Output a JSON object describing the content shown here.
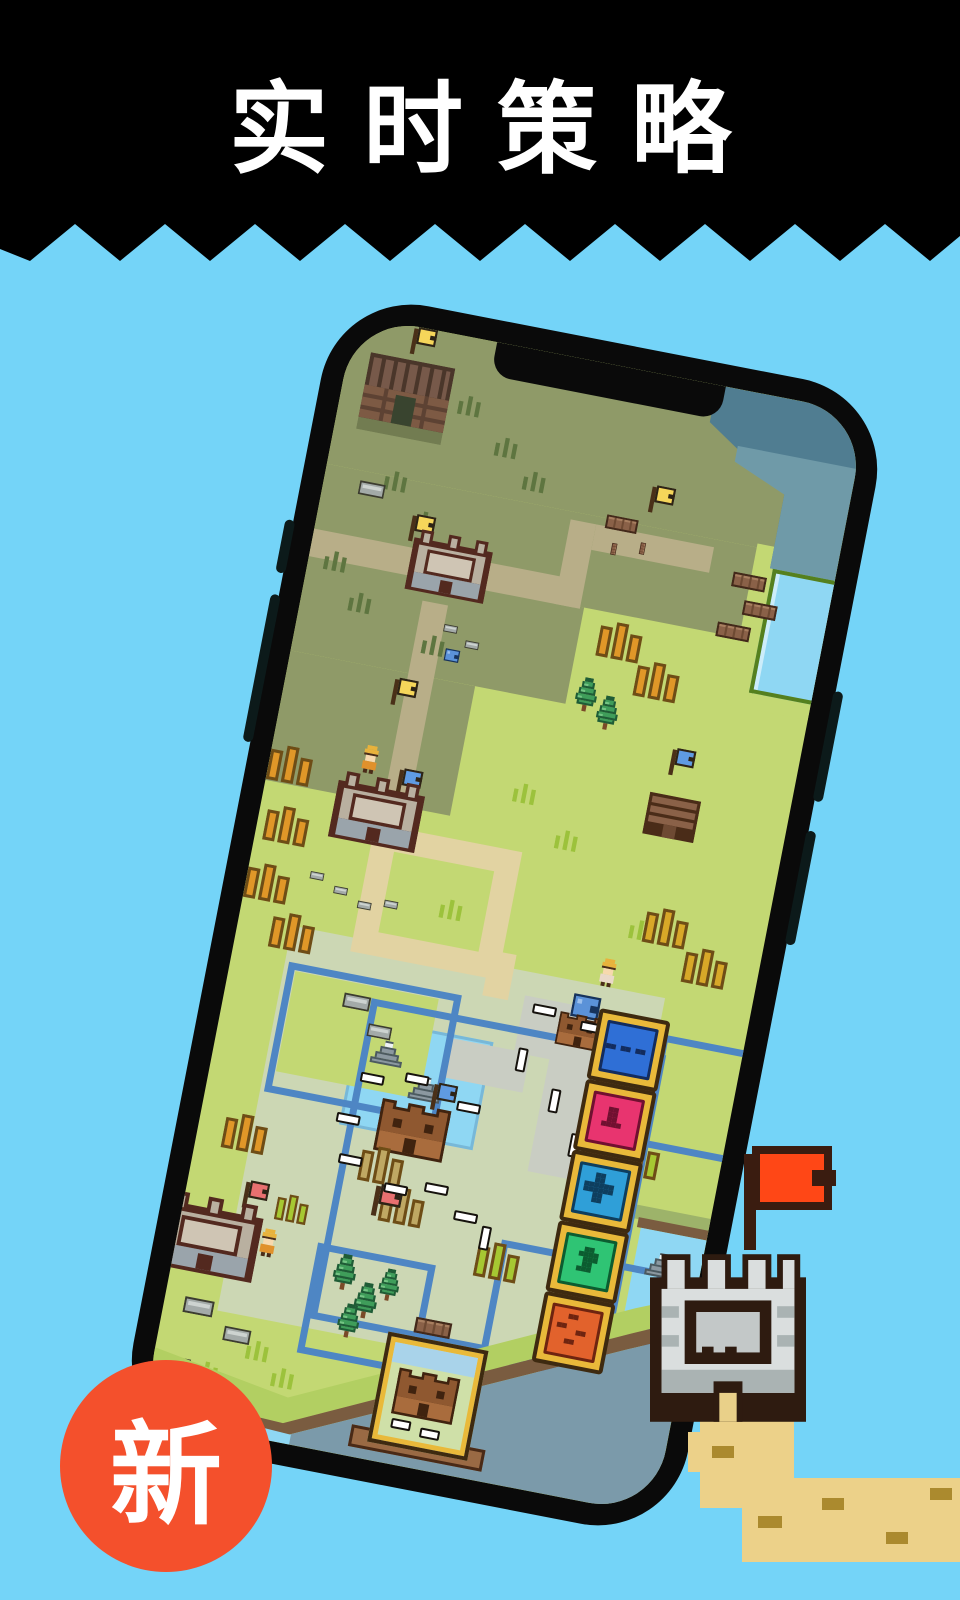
{
  "banner": {
    "title": "实时策略"
  },
  "badge": {
    "label": "新"
  },
  "colors": {
    "--bg": "#74d4f8",
    "--banner-bg": "#000000",
    "--banner-text": "#ffffff",
    "--badge-bg": "#f4502c",
    "--badge-text": "#ffffff",
    "--bezel": "#0a0a0a",
    "--bezel-btn": "#0c1a1a",
    "--grass": "#c3d873",
    "--grass-fog": "#8f9a68",
    "--sage": "#ccd7b4",
    "--water": "#8fd7f3",
    "--water-fog": "#507d91",
    "--water-fog2": "#6f9aa8",
    "--river-fog": "#7b9aaa",
    "--path": "#e2d3a2",
    "--path-fog": "#b8ae88",
    "--plaza": "#c9cdc3",
    "--border-blue": "#4e86c4",
    "--bank": "#b2cf62",
    "--dirt": "#7a5c40",
    "--rail-wood": "#8a5a38",
    "--gold": "#e9b93a",
    "--gold-dark": "#3e2a10",
    "--sand": "#ecd189",
    "--sand-dash": "#ab8a2e",
    "--castle-white": "#dadede",
    "--flag-red": "#ff4716"
  },
  "game": {
    "unit_buttons": [
      {
        "id": "unit-button-ellipsis",
        "icon": "ellipsis-icon",
        "color": "#2f6fd6",
        "dark": "#132c5e"
      },
      {
        "id": "unit-button-tee",
        "icon": "tee-icon",
        "color": "#e8346f",
        "dark": "#701030"
      },
      {
        "id": "unit-button-plus",
        "icon": "plus-icon",
        "color": "#2f9fd8",
        "dark": "#0e3e5e"
      },
      {
        "id": "unit-button-knight",
        "icon": "knight-icon",
        "color": "#2fc474",
        "dark": "#0c5c30"
      },
      {
        "id": "unit-button-dots",
        "icon": "dots-icon",
        "color": "#e2622c",
        "dark": "#6e2410"
      }
    ],
    "flag_colors": {
      "yellow": "#f6d65a",
      "blue": "#5f9be2",
      "red": "#e87070"
    }
  }
}
